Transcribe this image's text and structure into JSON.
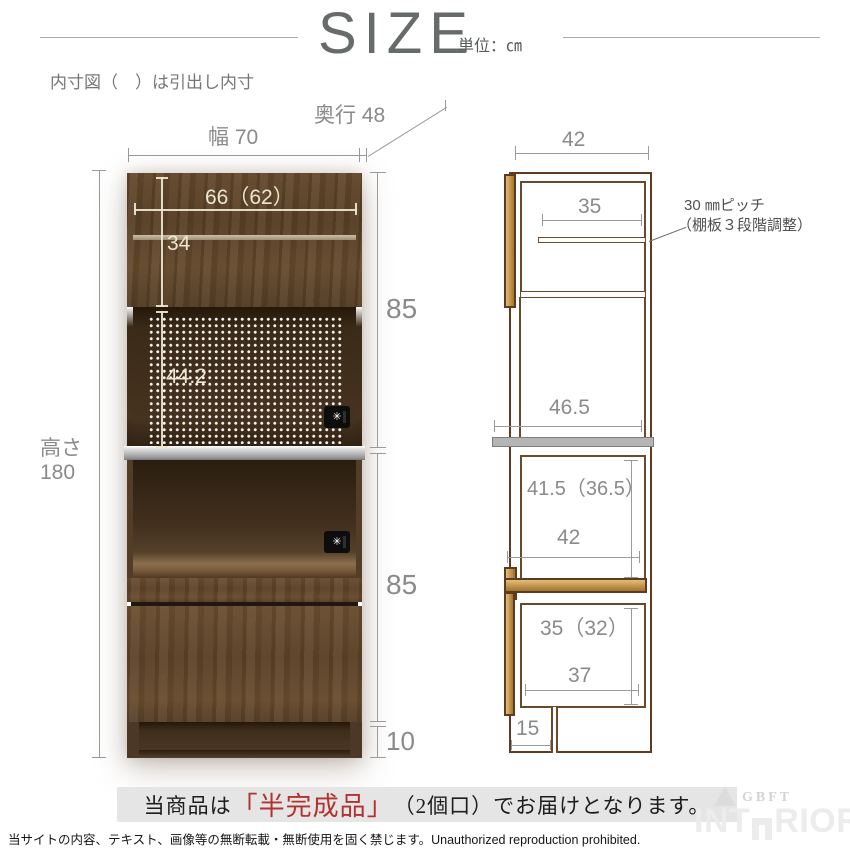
{
  "colors": {
    "dim_line": "#9a9a9a",
    "dim_text": "#8a8a8a",
    "photo_dim_text": "#ece5d2",
    "drawing_outline": "#5f3c20",
    "drawing_wood_fill": "#c89c55",
    "counter_gray": "#b5b5b5",
    "banner_bg": "#e5e5e5",
    "banner_red": "#b23230"
  },
  "header": {
    "title": "SIZE",
    "unit": "単位：㎝"
  },
  "note": "内寸図（　）は引出し内寸",
  "front_view": {
    "width": "幅 70",
    "depth": "奥行 48",
    "height_line1": "高さ",
    "height_line2": "180",
    "inner_top_width": "66（62）",
    "door_height": "34",
    "niche_height": "44.2",
    "upper_section_height": "85",
    "lower_section_height": "85",
    "base_height": "10"
  },
  "side_view": {
    "outer_depth": "42",
    "shelf_depth": "35",
    "shelf_note_line1": "30 ㎜ピッチ",
    "shelf_note_line2": "（棚板３段階調整）",
    "counter_depth": "46.5",
    "mid_inner_height": "41.5（36.5）",
    "mid_inner_depth": "42",
    "drawer_inner_height": "35（32）",
    "drawer_inner_depth": "37",
    "toe_kick_depth": "15"
  },
  "outlet_icon": "✳",
  "banner": {
    "prefix": "当商品は",
    "highlight": "「半完成品」",
    "count": "（2個口）",
    "suffix": "でお届けとなります。"
  },
  "footer": "当サイトの内容、テキスト、画像等の無断転載・無断使用を固く禁じます。Unauthorized reproduction prohibited.",
  "watermark": {
    "brand_small": "GBFT",
    "brand_left": "INT",
    "brand_right": "RIOR"
  }
}
